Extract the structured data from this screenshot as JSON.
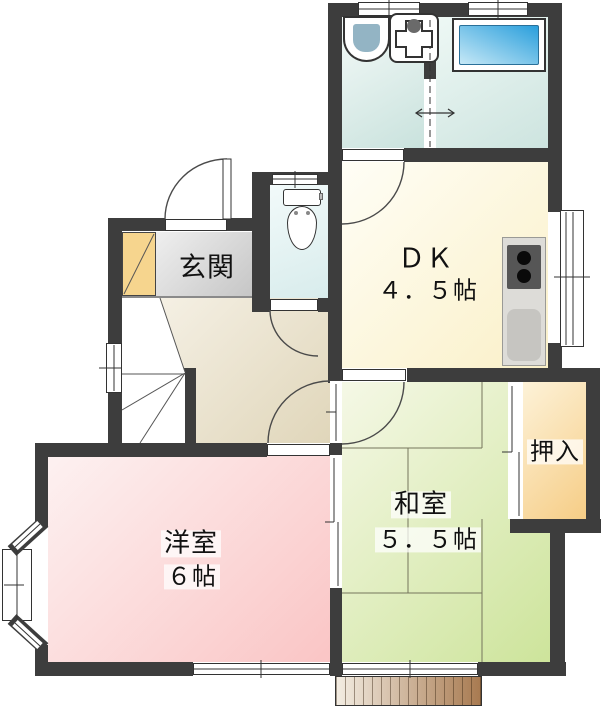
{
  "floorplan": {
    "rooms": {
      "genkan": {
        "label": "玄関"
      },
      "dk": {
        "label": "ＤＫ",
        "size": "４．５帖"
      },
      "washitsu": {
        "label": "和室",
        "size": "５．５帖"
      },
      "oshiire": {
        "label": "押入"
      },
      "yoshitsu": {
        "label": "洋室",
        "size": "６帖"
      }
    },
    "fixtures": [
      "bathtub-icon",
      "washbasin-icon",
      "laundry-pan-icon",
      "toilet-icon",
      "kitchen-stove-icon",
      "kitchen-sink-icon",
      "staircase",
      "entrance-door",
      "sliding-door",
      "bay-window",
      "wood-deck"
    ],
    "colors": {
      "wall": "#3d3d3d",
      "dk_floor": "#faf0c8",
      "genkan_floor": "#c6c6c6",
      "cabinet": "#f6d58e",
      "hallway_floor": "#e0d6ba",
      "washitsu_floor": "#cde49b",
      "oshiire_floor": "#f6cd86",
      "yoshitsu_floor": "#fac5c5",
      "washroom_floor": "#c9e2dd",
      "toilet_floor": "#d8ecec",
      "bathtub": "#2a9fdc",
      "deck": "#a87a50"
    }
  }
}
